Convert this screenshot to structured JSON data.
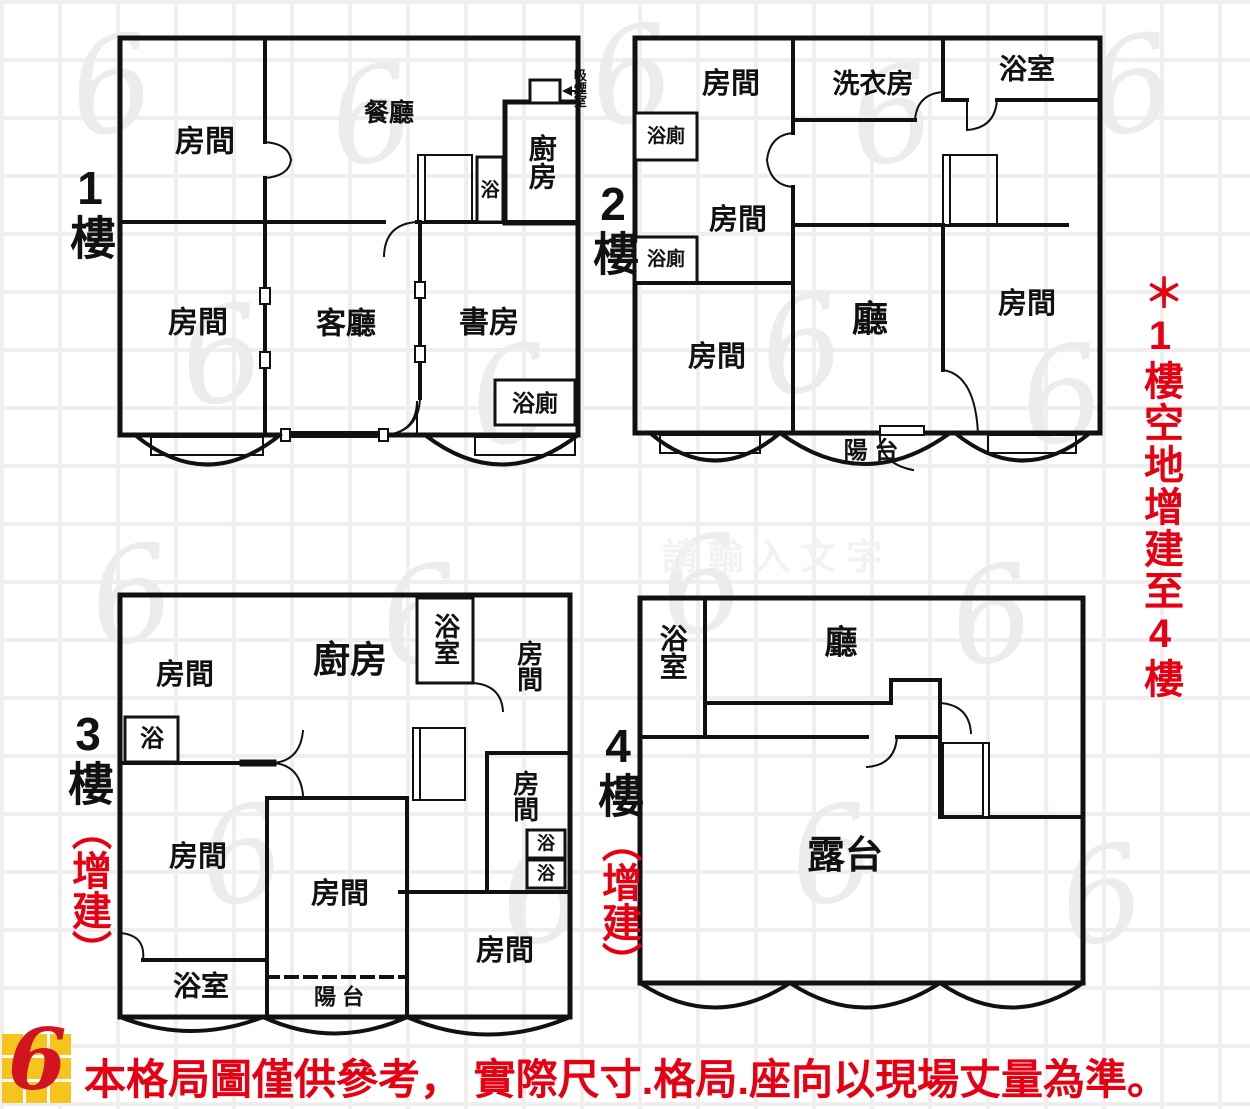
{
  "page": {
    "accent_red": "#e60012",
    "wall_color": "#111111",
    "tile_line": "#f1efee"
  },
  "watermark_center": "請輸入文字",
  "side_note": "＊1樓空地增建至4樓",
  "disclaimer": "本格局圖僅供參考， 實際尺寸.格局.座向以現場丈量為準。",
  "logo": {
    "glyph": "6",
    "grid_color": "#f5c51d",
    "swoosh_color": "#d11420"
  },
  "floors": [
    {
      "tag": "1樓",
      "annex": "",
      "rooms": {
        "bedroom_tl": "房間",
        "dining": "餐廳",
        "kitchen": "廚房",
        "bath": "浴",
        "smoking": "吸煙室",
        "bedroom_bl": "房間",
        "living": "客廳",
        "study": "書房",
        "bath_toilet": "浴廁"
      }
    },
    {
      "tag": "2樓",
      "annex": "",
      "rooms": {
        "bedroom_tl": "房間",
        "laundry": "洗衣房",
        "bathroom": "浴室",
        "bath_toilet_1": "浴廁",
        "bedroom_ml": "房間",
        "bath_toilet_2": "浴廁",
        "bedroom_bl": "房間",
        "hall": "廳",
        "bedroom_r": "房間",
        "balcony": "陽 台"
      }
    },
    {
      "tag": "3樓",
      "annex": "（增建）",
      "rooms": {
        "bedroom_tl": "房間",
        "kitchen": "廚房",
        "bathroom_top": "浴室",
        "bedroom_tr": "房間",
        "bath_left": "浴",
        "bedroom_mr": "房間",
        "bath_1": "浴",
        "bath_2": "浴",
        "bedroom_ml": "房間",
        "bedroom_c": "房間",
        "bedroom_br": "房間",
        "bathroom_bl": "浴室",
        "balcony": "陽 台"
      }
    },
    {
      "tag": "4樓",
      "annex": "（增建）",
      "rooms": {
        "bathroom": "浴室",
        "hall": "廳",
        "terrace": "露台"
      }
    }
  ]
}
